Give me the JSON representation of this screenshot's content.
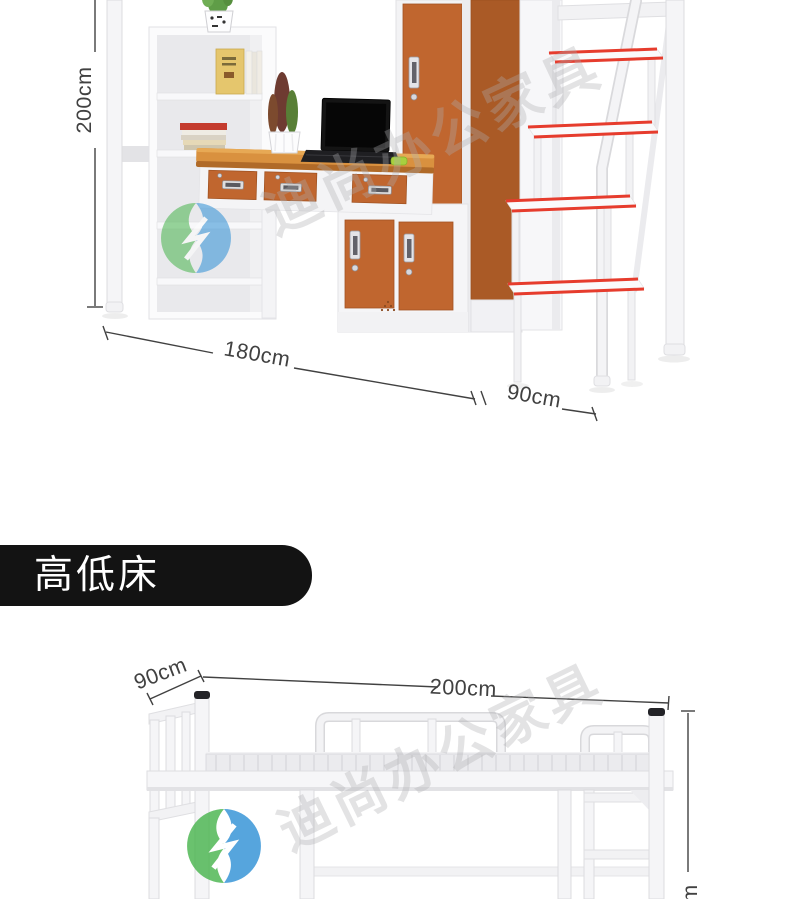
{
  "top_photo": {
    "dim_height": "200cm",
    "dim_width": "180cm",
    "dim_depth": "90cm"
  },
  "banner": {
    "title": "高低床"
  },
  "bottom_photo": {
    "dim_depth": "90cm",
    "dim_length": "200cm",
    "dim_height_partial": "cm"
  },
  "watermark": {
    "text": "迪尚办公家具"
  },
  "palette": {
    "orange_top": "#d9913f",
    "orange_top_light": "#e7a955",
    "orange_top_edge": "#b06a28",
    "orange_door": "#c0662f",
    "orange_door_dark": "#aa5a26",
    "red_step": "#e63c2d",
    "banner_bg": "#131313",
    "banner_fg": "#ffffff",
    "dim_color": "#414141",
    "wm_green": "#46b44b",
    "wm_blue": "#2d8fd5",
    "frame_white": "#f5f5f7",
    "frame_stroke": "#dcdcdf"
  }
}
